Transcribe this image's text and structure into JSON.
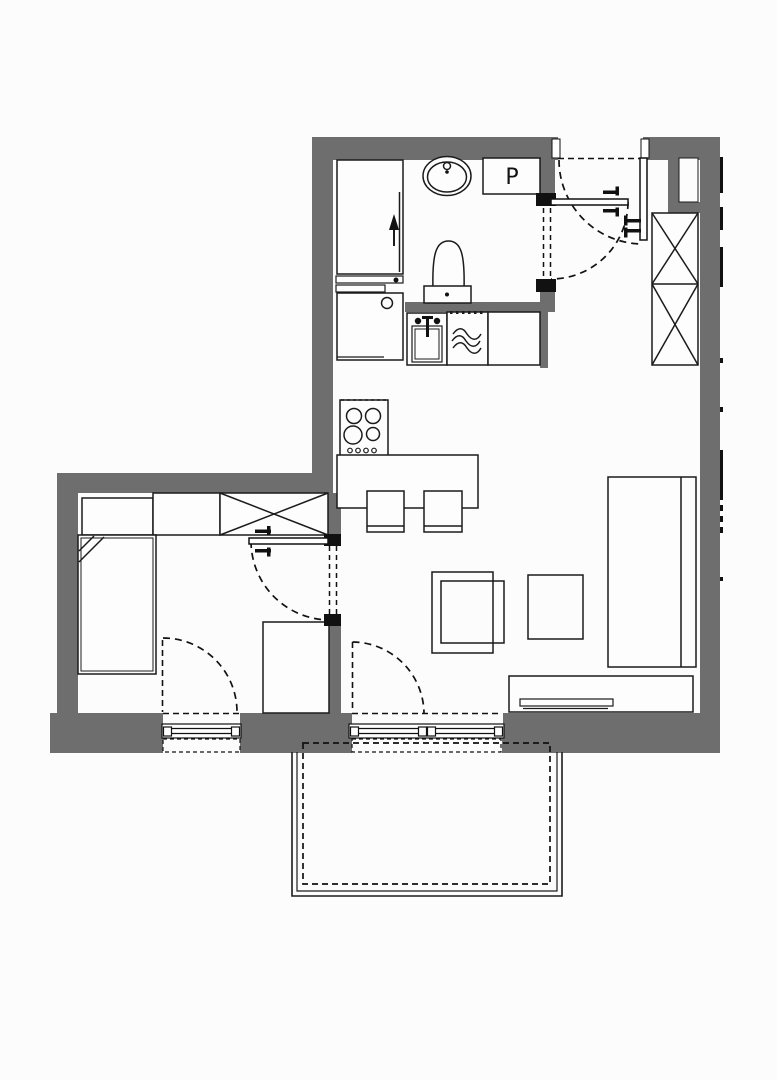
{
  "page": {
    "background": "#fcfcfc"
  },
  "colors": {
    "wall": "#6e6e6e",
    "line": "#1b1b1b",
    "hinge": "#111111",
    "background": "#fcfcfc",
    "furniture_fill": "#fdfdfd"
  },
  "labels": {
    "washing_machine": "P"
  },
  "fixtures": [
    "shower",
    "water-heater",
    "washbasin",
    "washing-machine",
    "toilet",
    "kitchen-sink",
    "dishwasher",
    "hob",
    "kitchen-island",
    "bar-stool",
    "hall-wardrobe",
    "bedroom-wardrobe",
    "dresser",
    "bed",
    "desk",
    "sofa",
    "coffee-table",
    "side-table",
    "tv-stand",
    "tv",
    "balcony"
  ]
}
